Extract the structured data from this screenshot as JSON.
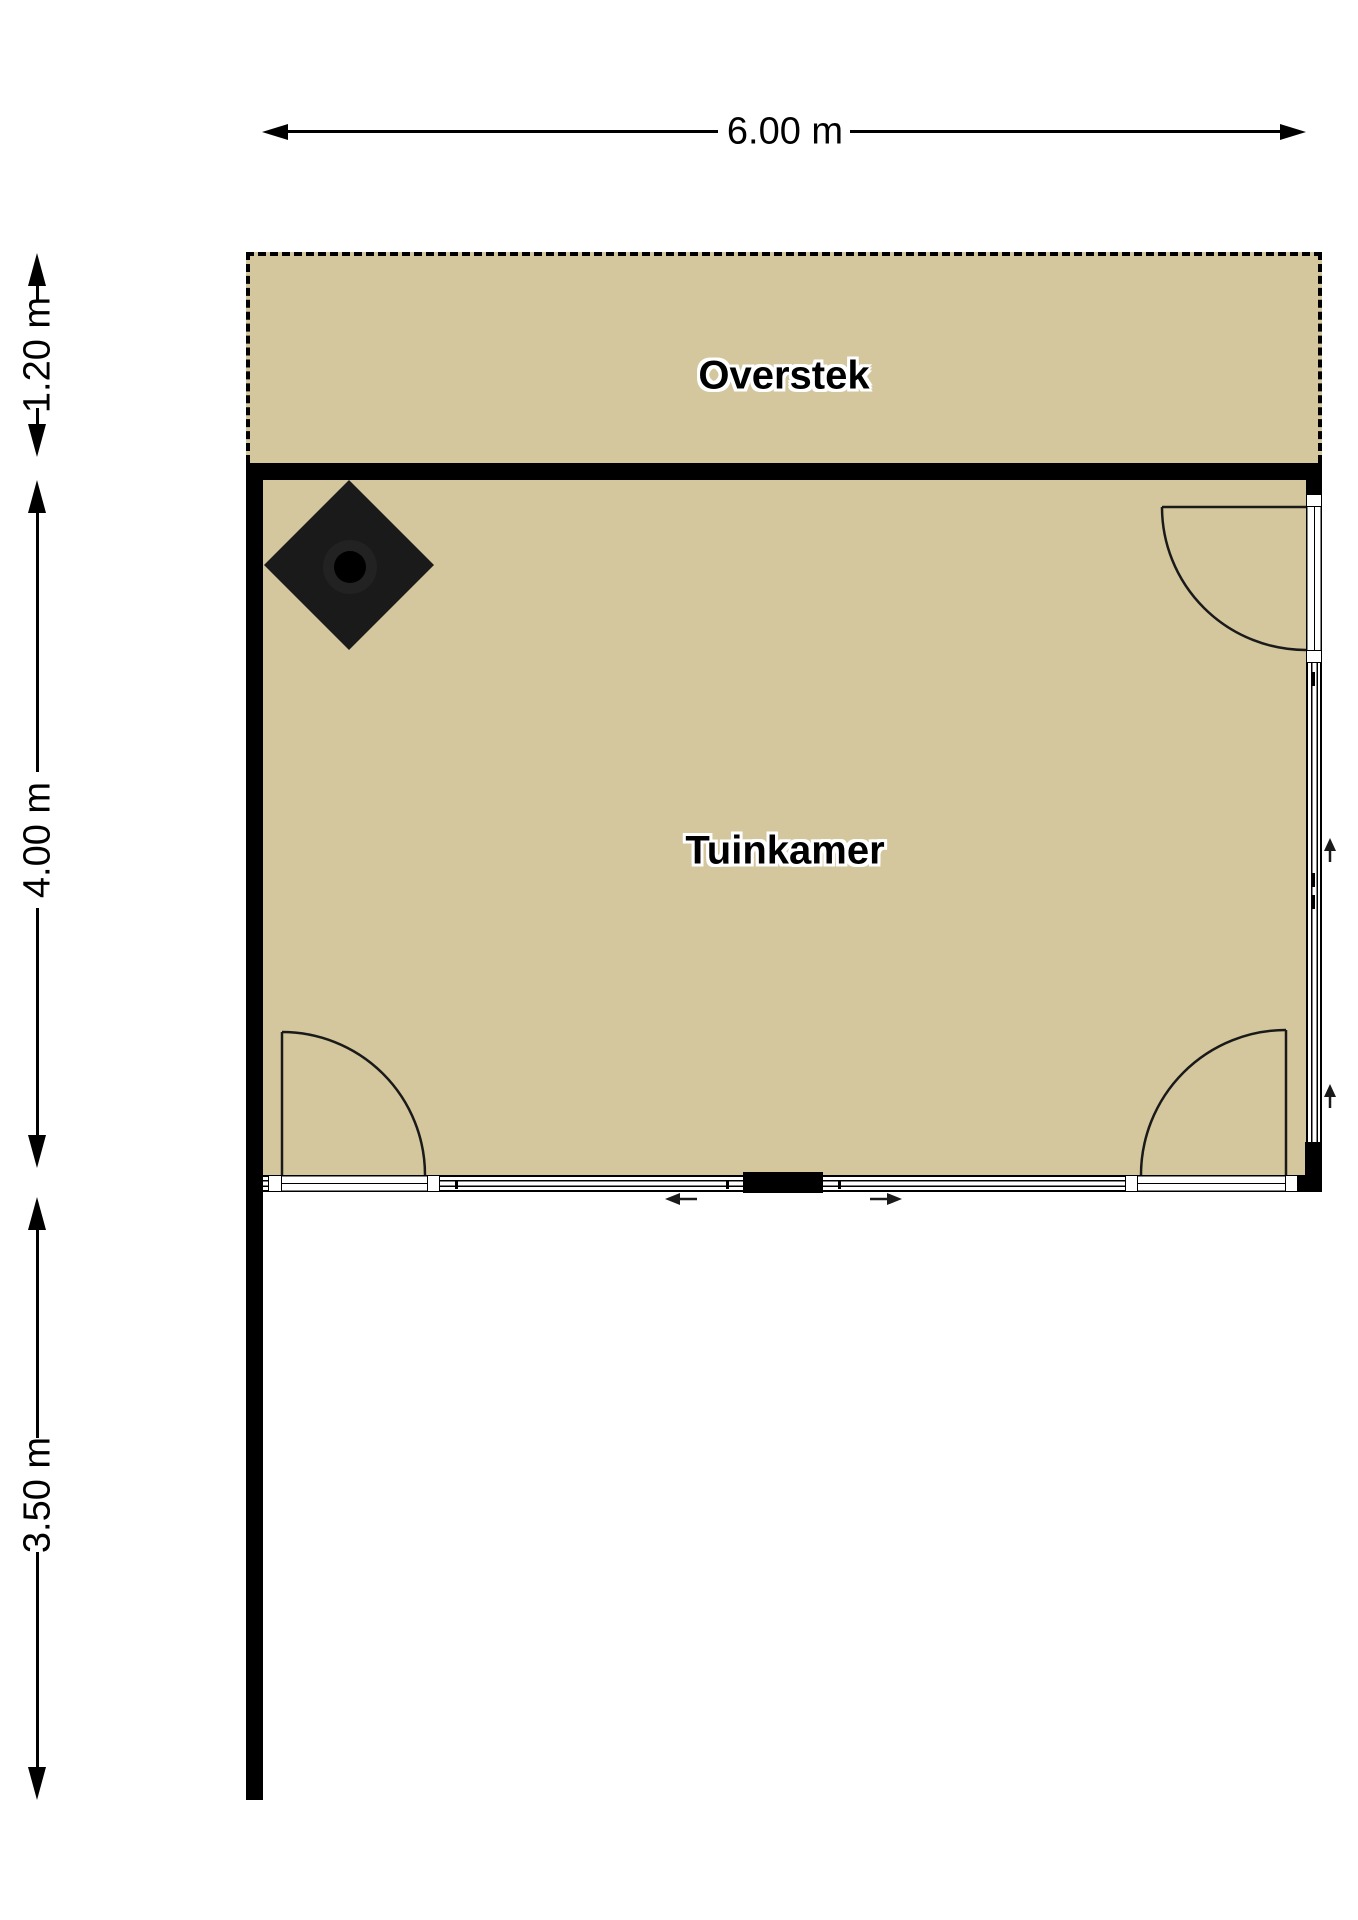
{
  "floorplan": {
    "background_color": "#ffffff",
    "floor_color": "#d4c79e",
    "wall_color": "#000000",
    "areas": {
      "overstek": {
        "label": "Overstek"
      },
      "tuinkamer": {
        "label": "Tuinkamer"
      }
    },
    "dimensions": {
      "width": {
        "label": "6.00 m"
      },
      "overstek_depth": {
        "label": "1.20 m"
      },
      "room_depth": {
        "label": "4.00 m"
      },
      "garden_wall_length": {
        "label": "3.50 m"
      }
    },
    "symbols": {
      "stove_icon": "wood-stove-diamond",
      "door_swing_icons": [
        "top-right-hinged-door",
        "bottom-left-hinged-door",
        "bottom-right-hinged-door"
      ],
      "sliding_door_arrow_icons": [
        "arrow-left",
        "arrow-right"
      ],
      "window_direction_arrow_icons": [
        "arrow-up",
        "arrow-up"
      ]
    }
  }
}
